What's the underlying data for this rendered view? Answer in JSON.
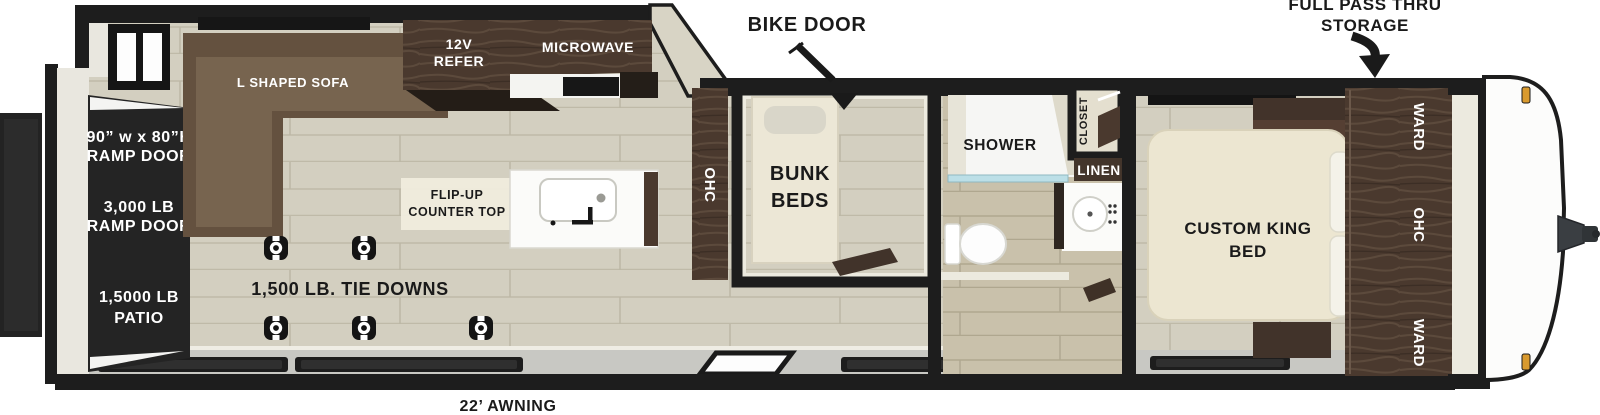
{
  "callouts": {
    "bike_door": "BIKE DOOR",
    "pass_thru_line1": "FULL PASS THRU",
    "pass_thru_line2": "STORAGE",
    "awning": "22’ AWNING",
    "tie_downs": "1,500 LB. TIE DOWNS"
  },
  "rear": {
    "ramp_size_line1": "90” w x 80”H",
    "ramp_size_line2": "RAMP DOOR",
    "ramp_weight_line1": "3,000 LB",
    "ramp_weight_line2": "RAMP DOOR",
    "patio_line1": "1,5000 LB",
    "patio_line2": "PATIO"
  },
  "garage": {
    "sofa": "L SHAPED SOFA",
    "refer_line1": "12V",
    "refer_line2": "REFER",
    "microwave": "MICROWAVE",
    "flip_up_line1": "FLIP-UP",
    "flip_up_line2": "COUNTER TOP",
    "ohc": "OHC"
  },
  "bunk_room": {
    "label_line1": "BUNK",
    "label_line2": "BEDS"
  },
  "bathroom": {
    "shower": "SHOWER",
    "closet": "CLOSET",
    "linen": "LINEN"
  },
  "bedroom": {
    "bed_line1": "CUSTOM KING",
    "bed_line2": "BED",
    "ward_top": "WARD",
    "ohc": "OHC",
    "ward_bottom": "WARD"
  },
  "colors": {
    "wall": "#1d1d1d",
    "floor": "#d3cfc0",
    "wood": "#4a392e",
    "sofa": "#6b5845",
    "bed_cream": "#ece6d1",
    "awning_gray": "#c8c8c3",
    "marker_light": "#d99a2e"
  }
}
